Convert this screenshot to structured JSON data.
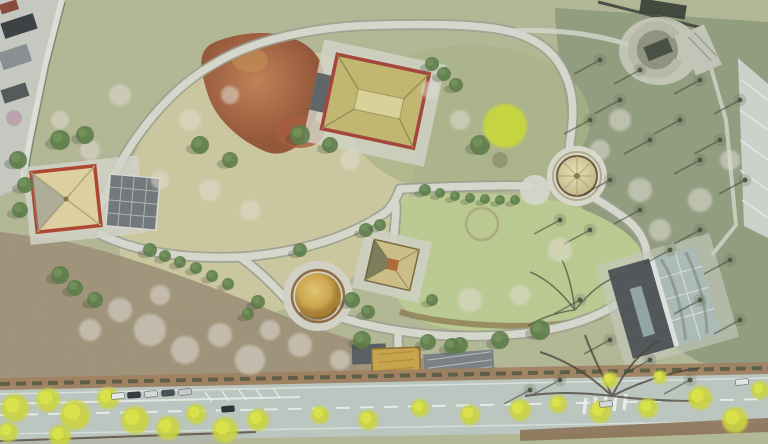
{
  "meta": {
    "title": "Aerial drone photograph of a heritage park in early spring",
    "type": "aerial-photograph",
    "season_hint": "early spring: budding yellow-green street trees, bare branches, pink-white blossom, brown scrub"
  },
  "palette": {
    "ground_base": "#b3b896",
    "meadow_pale": "#cfc9a2",
    "lawn_green": "#bccb93",
    "woods_olive": "#909c7e",
    "scrub_brown": "#9e9078",
    "red_scrub_a": "#b5693f",
    "red_scrub_b": "#8f4a2e",
    "path_fill": "#d7d9cf",
    "path_edge": "#9da092",
    "wall_stone": "#dfe1d8",
    "road_surface": "#bcc7c2",
    "lane_line": "#e9efe9",
    "sidewalk_hedge": "#a08061",
    "yellow_tree": "#ccd63f",
    "yellow_tree_light": "#dde649",
    "blossom_tree": "#e3ded4",
    "green_tree": "#5d7d49",
    "bright_spring_tree": "#c9d83c",
    "pavilion_roof_tan": "#ded2a2",
    "pavilion_roof_olive": "#c3b871",
    "pavilion_trim_red": "#b0452e",
    "panel_roof_grey": "#72787b",
    "dome_gold_a": "#d8b95e",
    "dome_gold_b": "#a87f33",
    "yurt_roof": "#e2d7ac",
    "stone_ring": "#b9b9a9",
    "modern_roof_dark": "#51575a",
    "modern_glass": "#adbcb8",
    "entrance_yellow": "#c9a54d",
    "shadow_dark": "#343f2e"
  },
  "structures": [
    {
      "name": "west-pavilion",
      "note": "square pavilion, cream pyramidal roof with red trim, stone forecourt"
    },
    {
      "name": "panel-roof-building",
      "note": "grey panelled roof annex east of west pavilion"
    },
    {
      "name": "north-pavilion",
      "note": "large hip-roofed hall, olive-tan roof with red eaves"
    },
    {
      "name": "central-kiosk-pavilion",
      "note": "small square kiosk with tan pyramid roof and dark eaves"
    },
    {
      "name": "golden-dome-yurt",
      "note": "gold dome on circular stone plinth"
    },
    {
      "name": "round-yurt",
      "note": "cream conical roof with radial ribs on circular plaza"
    },
    {
      "name": "stone-circle-ruin",
      "note": "C-shaped stone ring enclosure, north-east corner"
    },
    {
      "name": "modern-glass-hall",
      "note": "rotated hall, half dark metal roof, half glass skylight"
    },
    {
      "name": "entrance-gate",
      "note": "yellow-fronted gate building with grey roofs at street side"
    },
    {
      "name": "perimeter-wall",
      "note": "light stone wall along north-west boundary, houses outside"
    },
    {
      "name": "greenhouse-slope",
      "note": "pale hatched slope structure on east edge"
    },
    {
      "name": "earthwork-ring",
      "note": "faint circular ring traced in the lawn"
    }
  ],
  "road": {
    "lanes": 2,
    "features": "parked cars on north kerb, angled bay markings, crosswalk bars, street trees in fresh yellow leaf"
  },
  "scatter": {
    "yellow_trees": [
      [
        15,
        408,
        14
      ],
      [
        48,
        400,
        12
      ],
      [
        75,
        415,
        15
      ],
      [
        108,
        398,
        11
      ],
      [
        135,
        420,
        14
      ],
      [
        168,
        428,
        12
      ],
      [
        196,
        414,
        10
      ],
      [
        225,
        430,
        13
      ],
      [
        258,
        420,
        11
      ],
      [
        320,
        415,
        9
      ],
      [
        368,
        420,
        10
      ],
      [
        420,
        408,
        9
      ],
      [
        470,
        415,
        10
      ],
      [
        520,
        410,
        11
      ],
      [
        558,
        404,
        9
      ],
      [
        600,
        412,
        11
      ],
      [
        648,
        408,
        10
      ],
      [
        700,
        398,
        12
      ],
      [
        735,
        420,
        13
      ],
      [
        760,
        390,
        9
      ],
      [
        610,
        380,
        8
      ],
      [
        660,
        377,
        7
      ],
      [
        8,
        432,
        10
      ],
      [
        60,
        436,
        11
      ]
    ],
    "blossom_trees": [
      [
        150,
        330,
        16
      ],
      [
        185,
        350,
        14
      ],
      [
        220,
        335,
        12
      ],
      [
        250,
        360,
        15
      ],
      [
        120,
        310,
        12
      ],
      [
        90,
        330,
        11
      ],
      [
        270,
        330,
        10
      ],
      [
        160,
        295,
        10
      ],
      [
        300,
        345,
        12
      ],
      [
        340,
        360,
        10
      ],
      [
        470,
        300,
        12
      ],
      [
        520,
        295,
        10
      ],
      [
        560,
        250,
        12
      ],
      [
        600,
        150,
        10
      ],
      [
        640,
        190,
        12
      ],
      [
        660,
        230,
        11
      ],
      [
        700,
        200,
        12
      ],
      [
        730,
        160,
        10
      ],
      [
        620,
        120,
        11
      ],
      [
        90,
        150,
        10
      ],
      [
        120,
        95,
        11
      ],
      [
        60,
        120,
        9
      ],
      [
        160,
        180,
        9
      ],
      [
        210,
        190,
        11
      ],
      [
        250,
        210,
        10
      ],
      [
        460,
        120,
        10
      ],
      [
        430,
        90,
        9
      ],
      [
        350,
        160,
        10
      ],
      [
        190,
        120,
        11
      ],
      [
        230,
        95,
        9
      ]
    ],
    "green_trees": [
      [
        18,
        160,
        9
      ],
      [
        25,
        185,
        8
      ],
      [
        20,
        210,
        8
      ],
      [
        60,
        140,
        10
      ],
      [
        85,
        135,
        9
      ],
      [
        432,
        64,
        7
      ],
      [
        444,
        74,
        7
      ],
      [
        456,
        85,
        7
      ],
      [
        300,
        135,
        10
      ],
      [
        330,
        145,
        8
      ],
      [
        480,
        145,
        10
      ],
      [
        150,
        250,
        7
      ],
      [
        165,
        256,
        6
      ],
      [
        180,
        262,
        6
      ],
      [
        196,
        268,
        6
      ],
      [
        212,
        276,
        6
      ],
      [
        228,
        284,
        6
      ],
      [
        366,
        230,
        7
      ],
      [
        380,
        225,
        6
      ],
      [
        352,
        300,
        8
      ],
      [
        368,
        312,
        7
      ],
      [
        258,
        302,
        7
      ],
      [
        248,
        314,
        6
      ],
      [
        425,
        190,
        6
      ],
      [
        440,
        193,
        5
      ],
      [
        455,
        196,
        5
      ],
      [
        470,
        198,
        5
      ],
      [
        485,
        199,
        5
      ],
      [
        500,
        200,
        5
      ],
      [
        515,
        200,
        5
      ],
      [
        60,
        275,
        9
      ],
      [
        75,
        288,
        8
      ],
      [
        95,
        300,
        8
      ],
      [
        200,
        145,
        9
      ],
      [
        230,
        160,
        8
      ],
      [
        540,
        330,
        10
      ],
      [
        500,
        340,
        9
      ],
      [
        460,
        345,
        8
      ],
      [
        432,
        300,
        6
      ],
      [
        300,
        250,
        7
      ],
      [
        362,
        340,
        9
      ],
      [
        428,
        342,
        8
      ],
      [
        452,
        346,
        8
      ]
    ],
    "dark_trees": [
      [
        590,
        120
      ],
      [
        620,
        100
      ],
      [
        650,
        140
      ],
      [
        680,
        120
      ],
      [
        700,
        160
      ],
      [
        720,
        140
      ],
      [
        745,
        180
      ],
      [
        610,
        180
      ],
      [
        640,
        210
      ],
      [
        670,
        250
      ],
      [
        700,
        230
      ],
      [
        730,
        260
      ],
      [
        590,
        230
      ],
      [
        560,
        220
      ],
      [
        700,
        300
      ],
      [
        740,
        320
      ],
      [
        580,
        300
      ],
      [
        610,
        340
      ],
      [
        650,
        360
      ],
      [
        690,
        380
      ],
      [
        560,
        380
      ],
      [
        530,
        390
      ],
      [
        640,
        70
      ],
      [
        700,
        80
      ],
      [
        740,
        100
      ],
      [
        600,
        60
      ]
    ],
    "cars": [
      [
        118,
        396,
        "#e8eaea"
      ],
      [
        134,
        395,
        "#343a3e"
      ],
      [
        151,
        394,
        "#d8dadb"
      ],
      [
        168,
        393,
        "#4a5054"
      ],
      [
        185,
        392,
        "#c9ccce"
      ],
      [
        228,
        409,
        "#2e3338"
      ],
      [
        606,
        404,
        "#d5d8d9"
      ],
      [
        742,
        382,
        "#e2e5e6"
      ]
    ]
  }
}
